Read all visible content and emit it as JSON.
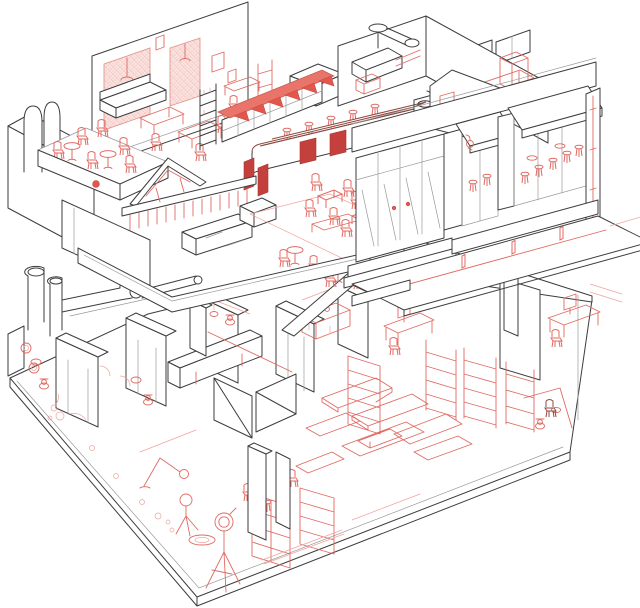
{
  "figure": {
    "kind": "axonometric-cutaway-wireframe",
    "description": "two-storey building interior cutaway line drawing",
    "palette": {
      "background": "#ffffff",
      "structure_line": "#3d3d3d",
      "structure_light": "#9a9a9a",
      "furnishing_line": "#e06a63",
      "furnishing_light": "#f0a39d",
      "accent_fill": "#e2564d",
      "panel_fill": "#c4403c",
      "hatch_fill": "#fbe7e4",
      "counter_line": "#8f4a40",
      "band_fill": "#e8746a"
    },
    "floors": [
      {
        "id": "upper",
        "areas": [
          "lounge",
          "terrace-balcony",
          "bar",
          "kitchen",
          "dining-area",
          "storefront-sidewalk"
        ]
      },
      {
        "id": "lower",
        "areas": [
          "utility-pipes",
          "restrooms",
          "corridor",
          "kitchenette",
          "workstations",
          "photo-studio",
          "shelving-stockroom",
          "display-platforms",
          "restroom-right"
        ]
      }
    ],
    "glyphs": [
      "chair-icon",
      "stool-icon",
      "round-table-icon",
      "square-table-icon",
      "toilet-icon",
      "tripod-light-icon",
      "awning-icon",
      "duct-icon",
      "shelf-icon",
      "bollard-icon"
    ]
  }
}
